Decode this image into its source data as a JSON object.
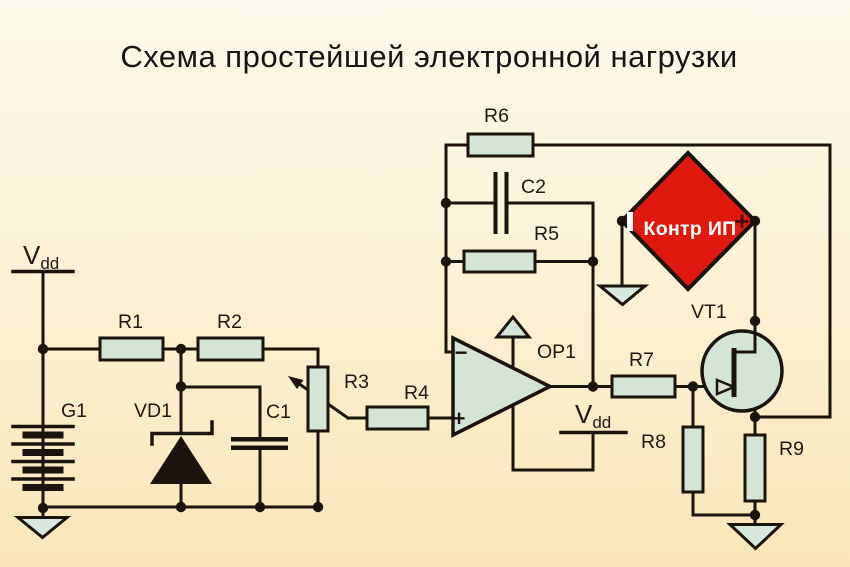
{
  "title": "Схема простейшей электронной нагрузки",
  "power_rail": {
    "name": "V",
    "sub": "dd"
  },
  "components": {
    "g1": "G1",
    "r1": "R1",
    "r2": "R2",
    "vd1": "VD1",
    "c1": "C1",
    "r3": "R3",
    "r4": "R4",
    "r5": "R5",
    "r6": "R6",
    "c2": "C2",
    "op1": "OP1",
    "r7": "R7",
    "r8": "R8",
    "r9": "R9",
    "vt1": "VT1"
  },
  "opamp": {
    "inverting_mark": "−",
    "noninverting_mark": "+"
  },
  "meter": {
    "label": "Контр ИП",
    "polarity_left": "−",
    "polarity_right": "+"
  },
  "colors": {
    "background_top": "#fdf9ea",
    "background_bottom": "#fae6b8",
    "line": "#1b140c",
    "component_fill": "#d4e5d6",
    "ground_fill": "#d7e8dc",
    "meter_fill": "#e0190f",
    "meter_text": "#ffffff",
    "label_text": "#201812"
  }
}
